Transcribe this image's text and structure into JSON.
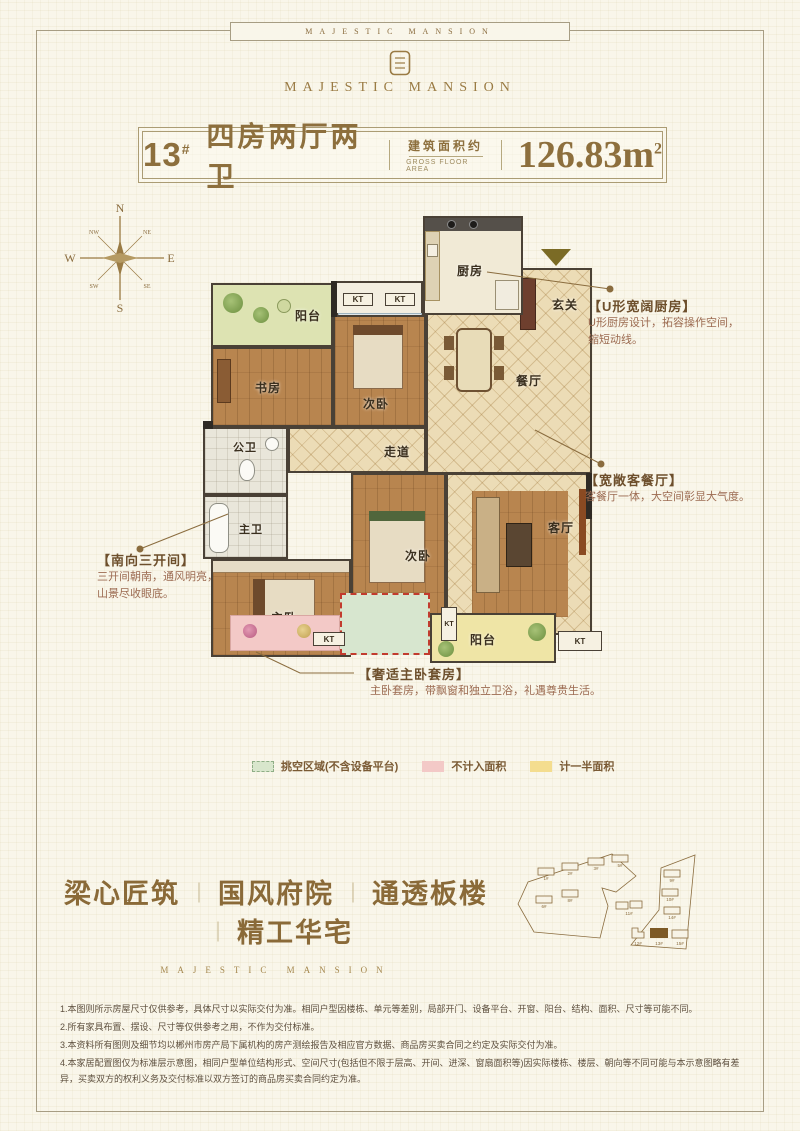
{
  "brand": {
    "frame_title": "MAJESTIC MANSION",
    "logo_text": "MAJESTIC MANSION",
    "slogan_sub": "MAJESTIC MANSION"
  },
  "header": {
    "unit_no": "13",
    "unit_sup": "#",
    "layout_name": "四房两厅两卫",
    "area_label_cn": "建筑面积约",
    "area_label_en": "GROSS FLOOR AREA",
    "area_value": "126.83m",
    "area_unit_sup": "2"
  },
  "compass": {
    "n": "N",
    "e": "E",
    "s": "S",
    "w": "W",
    "nw": "NW",
    "ne": "NE",
    "sw": "SW",
    "se": "SE"
  },
  "floorplan": {
    "kt": "KT",
    "rooms": {
      "balcony_top": "阳台",
      "study": "书房",
      "bedroom2": "次卧",
      "kitchen": "厨房",
      "foyer": "玄关",
      "dining": "餐厅",
      "public_bath": "公卫",
      "corridor": "走道",
      "master_bath": "主卫",
      "master_bedroom": "主卧",
      "bedroom3": "次卧",
      "living": "客厅",
      "balcony_bottom": "阳台"
    }
  },
  "callouts": {
    "kitchen": {
      "title": "【U形宽阔厨房】",
      "line1": "U形厨房设计，拓容操作空间，",
      "line2": "缩短动线。"
    },
    "living": {
      "title": "【宽敞客餐厅】",
      "line1": "客餐厅一体，大空间彰显大气度。"
    },
    "south": {
      "title": "【南向三开间】",
      "line1": "三开间朝南，通风明亮，",
      "line2": "山景尽收眼底。"
    },
    "master": {
      "title": "【奢适主卧套房】",
      "line1": "主卧套房，带飘窗和独立卫浴，礼遇尊贵生活。"
    }
  },
  "legend": {
    "items": [
      {
        "label": "挑空区域(不含设备平台)",
        "color": "#d8e6cc"
      },
      {
        "label": "不计入面积",
        "color": "#f3c9c7"
      },
      {
        "label": "计一半面积",
        "color": "#f4dd8f"
      }
    ]
  },
  "slogan": {
    "items": [
      "梁心匠筑",
      "国风府院",
      "通透板楼",
      "精工华宅"
    ],
    "divider": "｜"
  },
  "site_plan": {
    "buildings": [
      "1#",
      "2#",
      "3#",
      "5#",
      "6#",
      "8#",
      "11#",
      "9#",
      "10#",
      "14#",
      "12#",
      "13#",
      "15#"
    ],
    "highlighted": "13#"
  },
  "disclaimer": [
    "1.本图则所示房屋尺寸仅供参考，具体尺寸以实际交付为准。相同户型因楼栋、单元等差别，局部开门、设备平台、开窗、阳台、结构、面积、尺寸等可能不同。",
    "2.所有家具布置、摆设、尺寸等仅供参考之用，不作为交付标准。",
    "3.本资料所有图则及细节均以郴州市房产局下属机构的房产测绘报告及相应官方数据、商品房买卖合同之约定及实际交付为准。",
    "4.本家居配置图仅为标准层示意图，相同户型单位结构形式、空间尺寸(包括但不限于层高、开间、进深、窗扇面积等)因实际楼栋、楼层、朝向等不同可能与本示意图略有差异，买卖双方的权利义务及交付标准以双方签订的商品房买卖合同约定为准。"
  ]
}
